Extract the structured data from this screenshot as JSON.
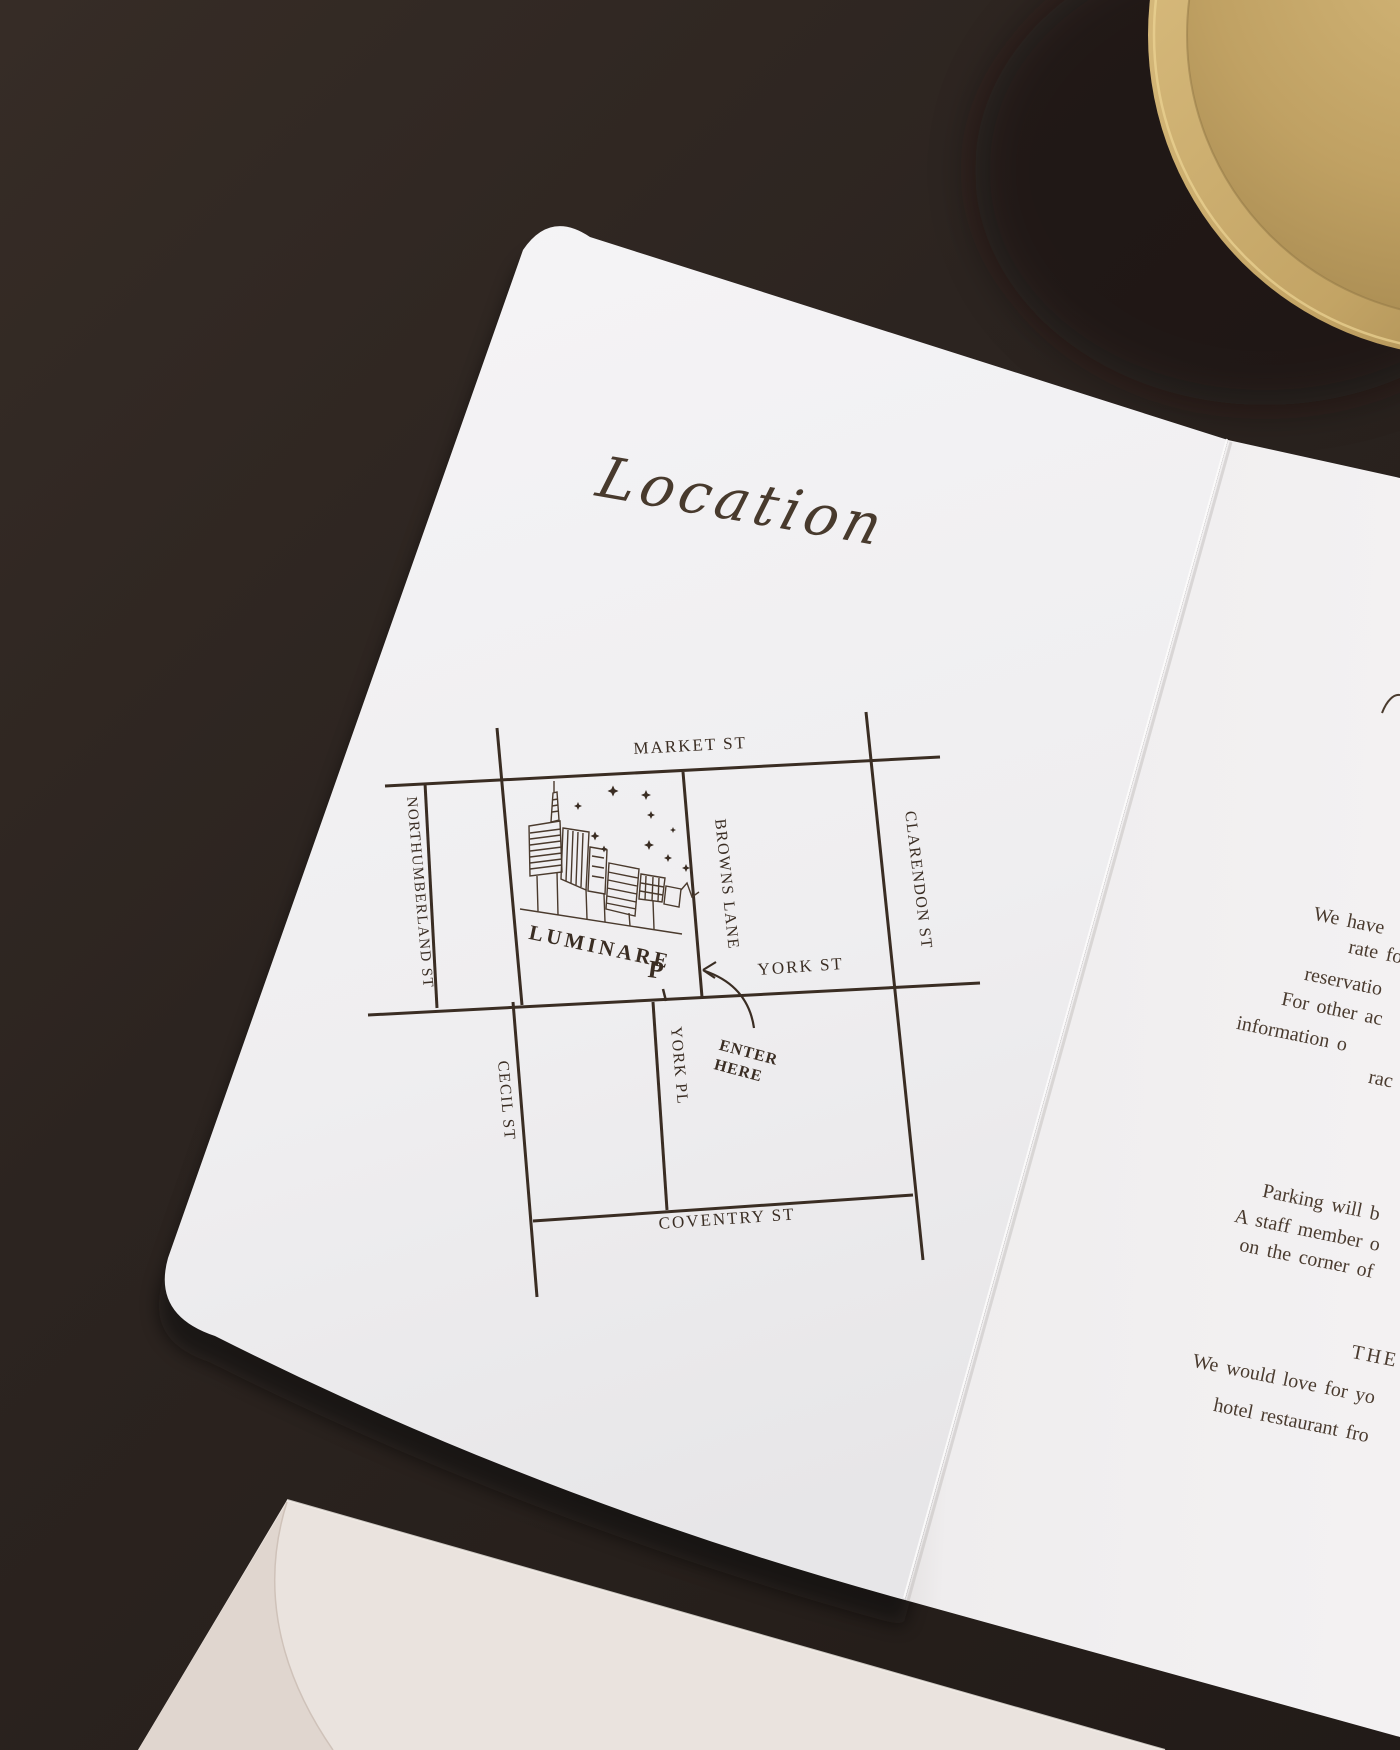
{
  "page": {
    "left_panel": {
      "title": "Location",
      "map": {
        "streets": {
          "market": "MARKET ST",
          "northumberland": "NORTHUMBERLAND ST",
          "browns": "BROWNS LANE",
          "clarendon": "CLARENDON ST",
          "york_st": "YORK ST",
          "york_pl": "YORK PL",
          "cecil": "CECIL ST",
          "coventry": "COVENTRY ST"
        },
        "venue_label": "LUMINARE",
        "parking_symbol": "P",
        "enter_line1": "ENTER",
        "enter_line2": "HERE"
      }
    },
    "right_panel": {
      "lines": [
        "We have",
        "rate for",
        "reservatio",
        "For other ac",
        "information o",
        "rac",
        "Parking will b",
        "A staff member o",
        "on the corner of",
        "THE",
        "We would love for yo",
        "hotel restaurant fro"
      ]
    },
    "colors": {
      "ink": "#3a2d23",
      "card_white": "#f1f0f2",
      "background_brown": "#2c2420",
      "envelope_blush": "#eae3de",
      "brass_gold": "#c7a765"
    }
  }
}
